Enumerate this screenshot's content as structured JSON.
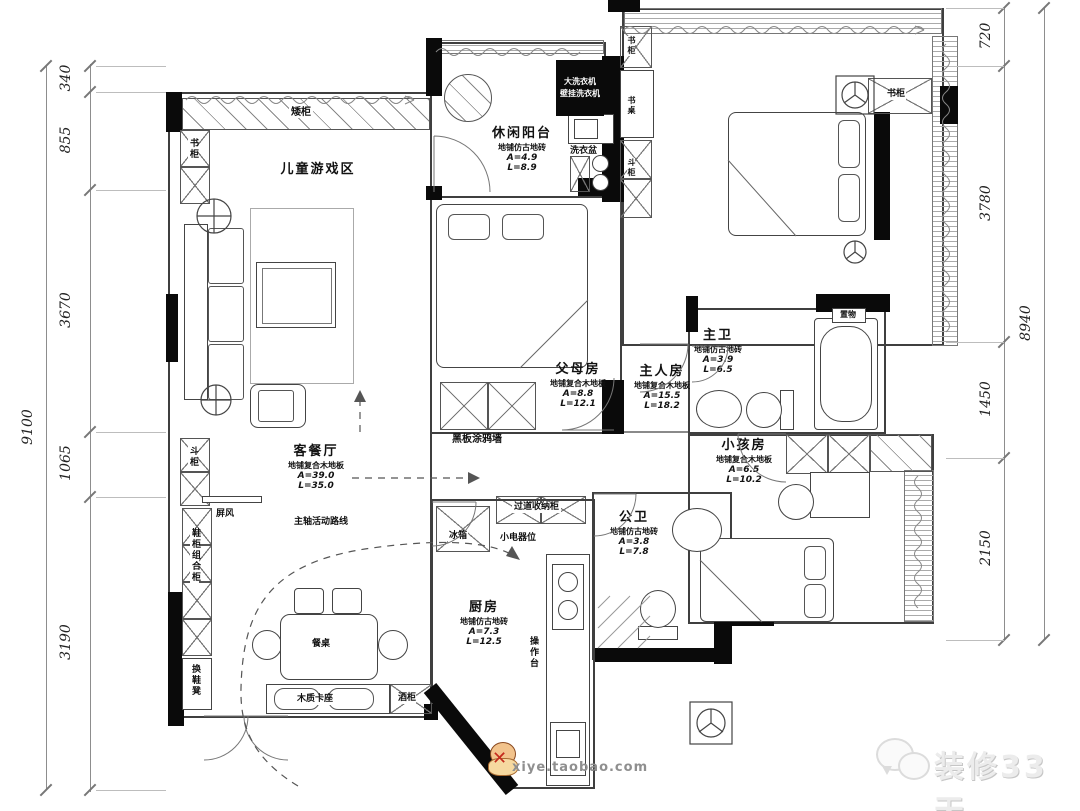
{
  "meta": {
    "type": "apartment-floor-plan"
  },
  "dimensions": {
    "left": {
      "total": "9100",
      "segments": [
        "340",
        "855",
        "3670",
        "1065",
        "3190"
      ]
    },
    "right": {
      "total": "8940",
      "segments": [
        "720",
        "3780",
        "1450",
        "2150"
      ]
    }
  },
  "rooms": {
    "play": {
      "name": "儿童游戏区"
    },
    "balcony": {
      "name": "休闲阳台",
      "floor": "地铺仿古地砖",
      "area": "A=4.9",
      "length": "L=8.9"
    },
    "parents": {
      "name": "父母房",
      "floor": "地铺复合木地板",
      "area": "A=8.8",
      "length": "L=12.1"
    },
    "master": {
      "name": "主人房",
      "floor": "地铺复合木地板",
      "area": "A=15.5",
      "length": "L=18.2"
    },
    "master_bath": {
      "name": "主卫",
      "floor": "地铺仿古地砖",
      "area": "A=3.9",
      "length": "L=6.5"
    },
    "kids": {
      "name": "小孩房",
      "floor": "地铺复合木地板",
      "area": "A=6.5",
      "length": "L=10.2"
    },
    "living_dining": {
      "name": "客餐厅",
      "floor": "地铺复合木地板",
      "area": "A=39.0",
      "length": "L=35.0"
    },
    "public_bath": {
      "name": "公卫",
      "floor": "地铺仿古地砖",
      "area": "A=3.8",
      "length": "L=7.8"
    },
    "kitchen": {
      "name": "厨房",
      "floor": "地铺仿古地砖",
      "area": "A=7.3",
      "length": "L=12.5"
    }
  },
  "labels": {
    "low_cabinet": "矮柜",
    "bookcase": "书柜",
    "desk": "书桌",
    "dresser": "斗柜",
    "laundry_sink": "洗衣盆",
    "shelf_niche": "置物",
    "blackboard": "黑板涂鸦墙",
    "hall_storage": "过道收纳柜",
    "fridge": "冰箱",
    "appliance_spot": "小电器位",
    "counter": "操作台",
    "screen": "屏风",
    "shoe_combo": "鞋柜组合柜",
    "bench": "换鞋凳",
    "dining_table": "餐桌",
    "booth": "木质卡座",
    "wine_cabinet": "酒柜",
    "route": "主轴活动路线"
  },
  "washer": {
    "line1": "大洗衣机",
    "line2": "壁挂洗衣机"
  },
  "watermark": {
    "brand": "装修33天",
    "site": "xiye.taobao.com"
  }
}
